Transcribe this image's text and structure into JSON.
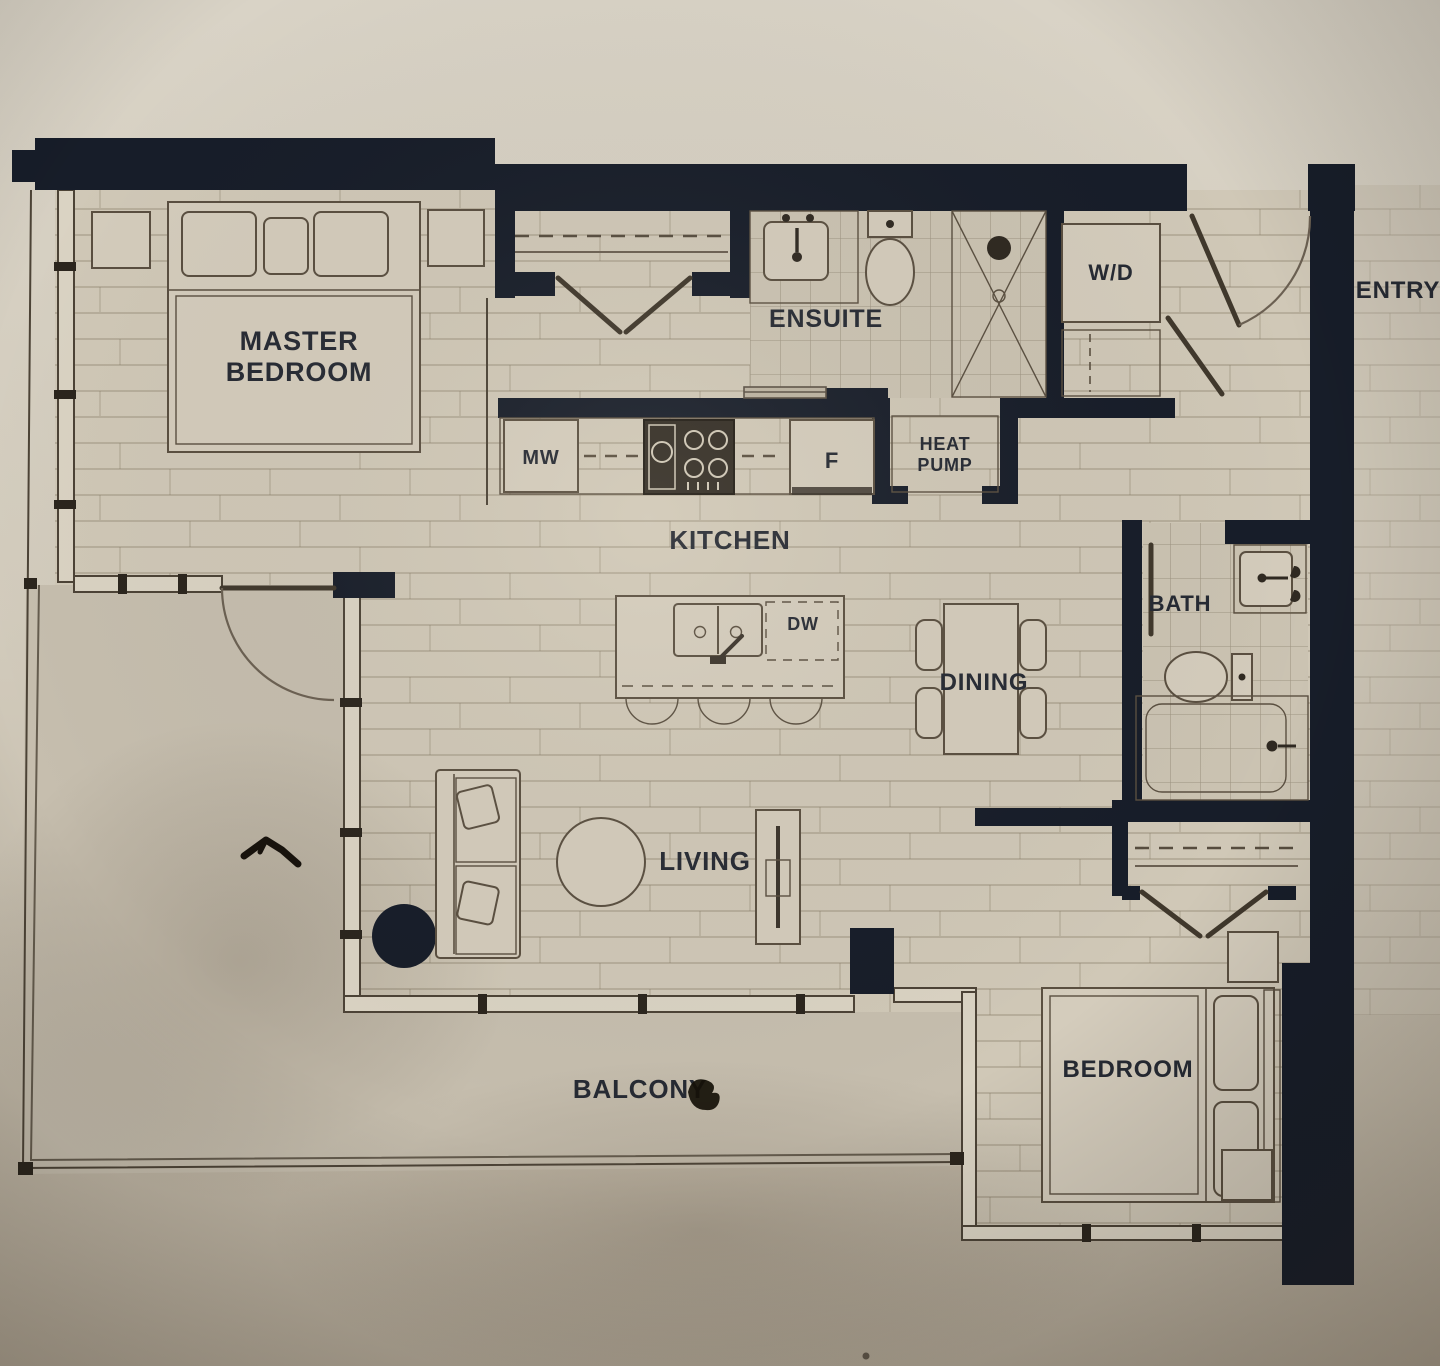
{
  "colors": {
    "wall": "#171d29",
    "ink": "#262a33",
    "line": "#5a4f40",
    "floor": "#d0c8b7",
    "balcony": "#c6beae",
    "background_top": "#d8d2c5",
    "background_bottom": "#b5ab9b"
  },
  "labels": {
    "master_line1": "MASTER",
    "master_line2": "BEDROOM",
    "ensuite": "ENSUITE",
    "wd": "W/D",
    "entry": "ENTRY",
    "mw": "MW",
    "fridge": "F",
    "heat_line1": "HEAT",
    "heat_line2": "PUMP",
    "kitchen": "KITCHEN",
    "dw": "DW",
    "dining": "DINING",
    "bath": "BATH",
    "living": "LIVING",
    "bedroom": "BEDROOM",
    "balcony": "BALCONY"
  }
}
